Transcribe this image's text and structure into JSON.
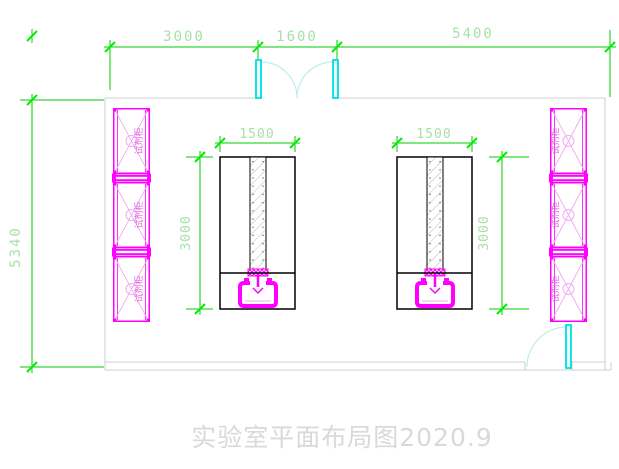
{
  "title": "实验室平面布局图2020.9",
  "dims": {
    "top_left": "3000",
    "top_mid": "1600",
    "top_right": "5400",
    "room_height": "5340",
    "bench1_width": "1500",
    "bench1_depth": "3000",
    "bench2_width": "1500",
    "bench2_depth": "3000"
  },
  "labels": {
    "cabinet": "试剂柜"
  },
  "colors": {
    "dimension_green": "#00cc00",
    "cabinet_magenta": "#ff00ff",
    "door_cyan": "#00dede",
    "wall_gray": "#cfcfcf",
    "title_gray": "#d9d9d9"
  }
}
